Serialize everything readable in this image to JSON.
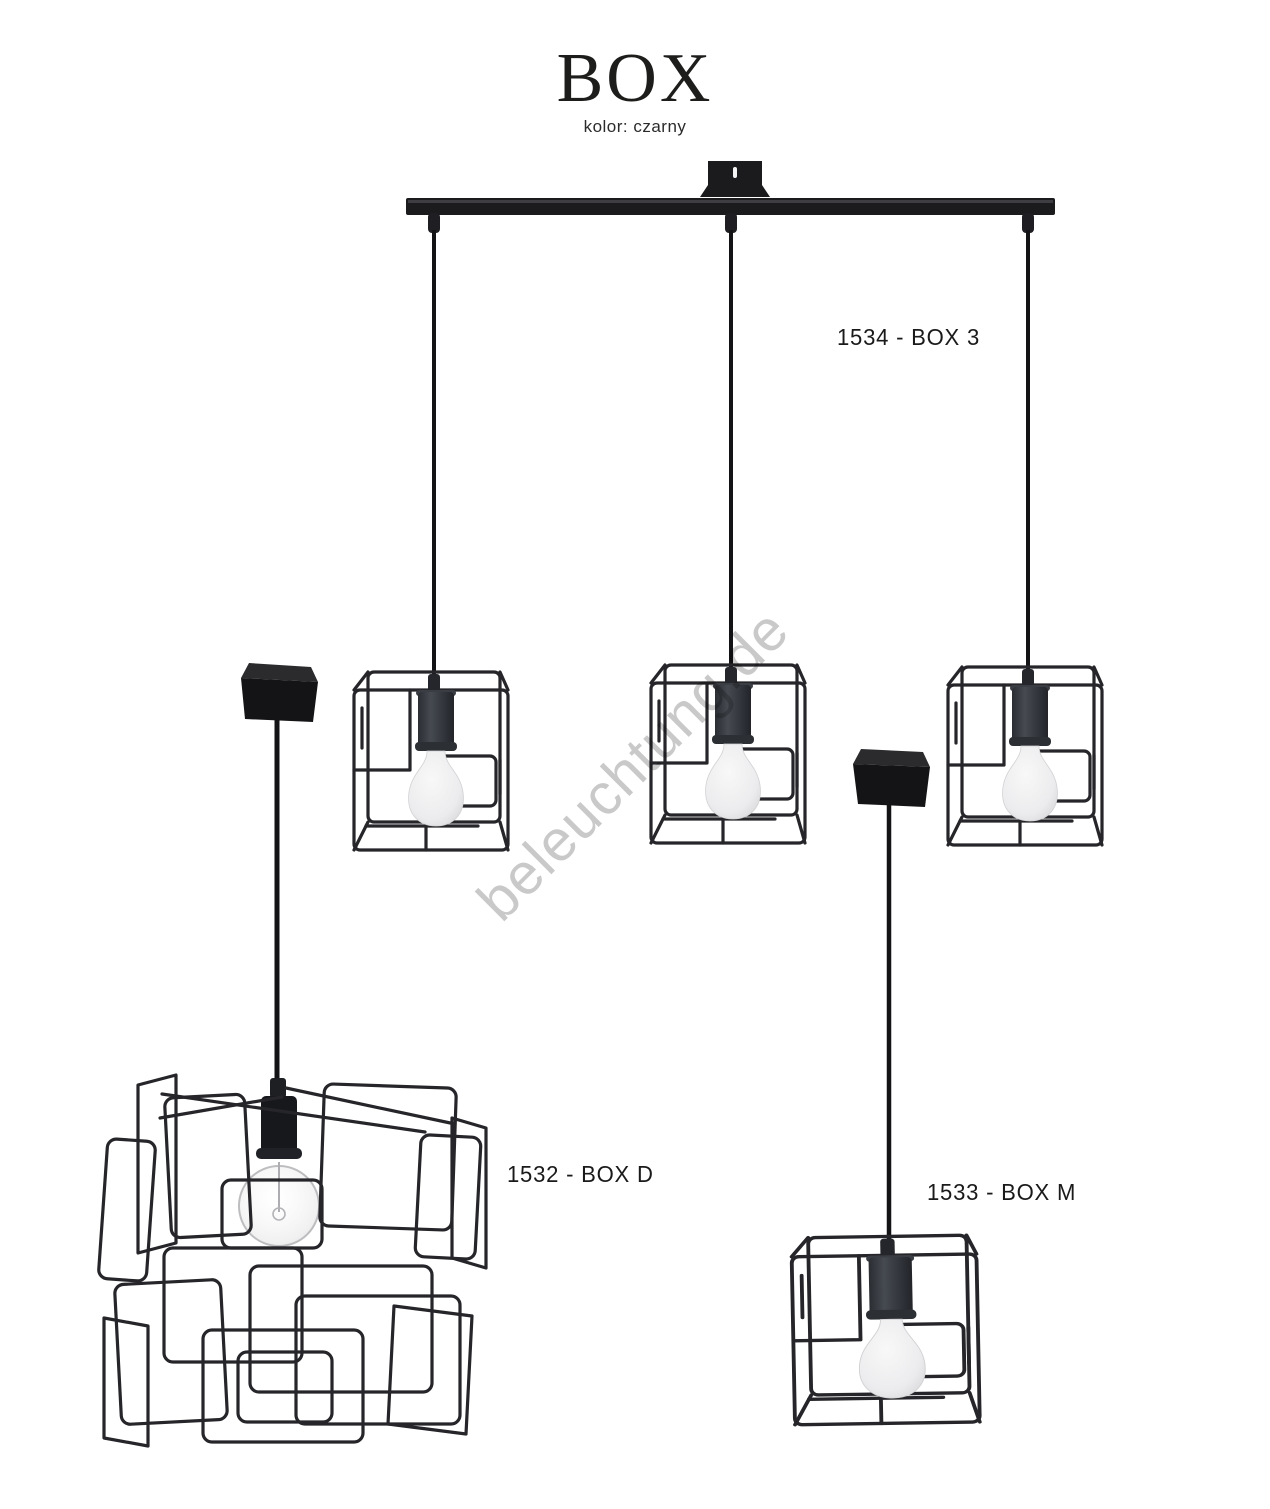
{
  "header": {
    "title": "BOX",
    "subtitle": "kolor: czarny"
  },
  "watermark": {
    "text": "beleuchtung.de"
  },
  "products": [
    {
      "code": "1534",
      "name": "BOX 3",
      "label": "1534 - BOX 3"
    },
    {
      "code": "1532",
      "name": "BOX D",
      "label": "1532 - BOX D"
    },
    {
      "code": "1533",
      "name": "BOX M",
      "label": "1533 - BOX M"
    }
  ],
  "colors": {
    "wire_black": "#26262a",
    "bar_black": "#1b1b1e",
    "socket_gray": "#34373d",
    "bulb_frosted": "#ededee",
    "watermark_gray": "#c9c9c9",
    "text_black": "#1a1a1a"
  }
}
